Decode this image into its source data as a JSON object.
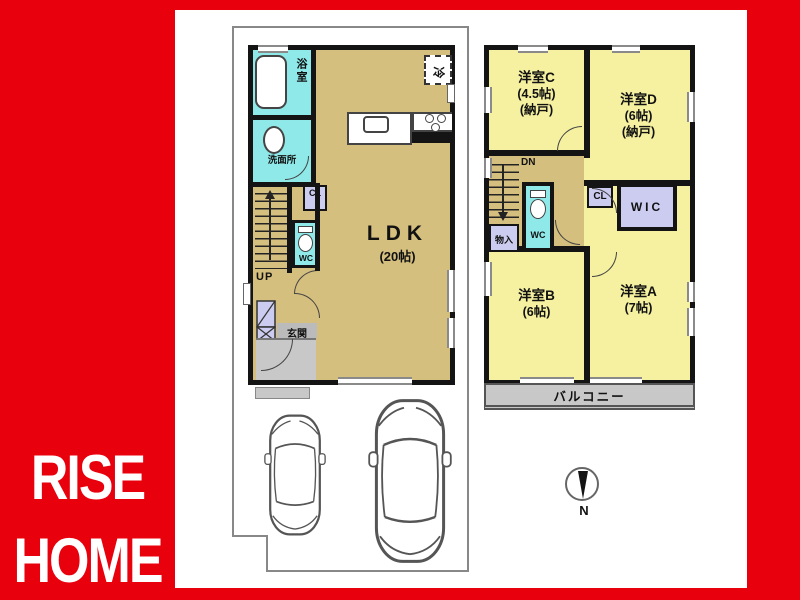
{
  "brand": {
    "rise": "RISE",
    "home": "HOME"
  },
  "floor1": {
    "ldk": "LDK",
    "ldk_size": "(20帖)",
    "bath": "浴室",
    "washroom": "洗面所",
    "wc": "WC",
    "closet": "CL",
    "up": "UP",
    "entrance": "玄関",
    "fridge": "冷"
  },
  "floor2": {
    "room_c": "洋室C",
    "room_c_size": "(4.5帖)",
    "room_c_note": "(納戸)",
    "room_d": "洋室D",
    "room_d_size": "(6帖)",
    "room_d_note": "(納戸)",
    "room_b": "洋室B",
    "room_b_size": "(6帖)",
    "room_a": "洋室A",
    "room_a_size": "(7帖)",
    "wc": "WC",
    "down": "DN",
    "storage": "物入",
    "closet": "CL",
    "wic": "WIC",
    "balcony": "バルコニー"
  },
  "compass": {
    "north": "N"
  },
  "colors": {
    "brand_red": "#e8000d",
    "room_tan": "#d5bf7e",
    "room_yellow": "#f6f1a0",
    "wet_area_cyan": "#8fe9e9",
    "closet_purple": "#ccccf0",
    "concrete_gray": "#c8c8c8"
  }
}
